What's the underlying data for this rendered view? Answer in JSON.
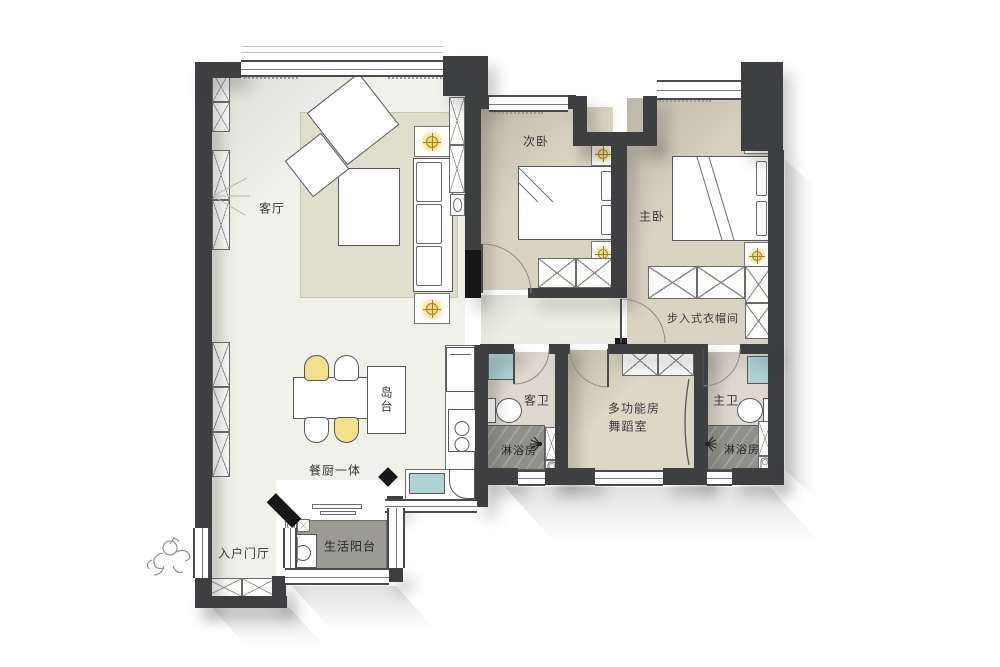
{
  "plan_type": "apartment-floor-plan",
  "rooms": {
    "living_room": "客厅",
    "secondary_bedroom": "次卧",
    "master_bedroom": "主卧",
    "walk_in_closet": "步入式衣帽间",
    "dining_kitchen": "餐厨一体",
    "kitchen_island": "岛台",
    "guest_bathroom": "客卫",
    "guest_shower_room": "淋浴房",
    "multifunction_room": "多功能房",
    "dance_studio": "舞蹈室",
    "master_bathroom": "主卫",
    "master_shower_room": "淋浴房",
    "entry_foyer": "入户门厅",
    "utility_balcony": "生活阳台"
  },
  "colors": {
    "wall": "#3e3f41",
    "floor_main": "#f0f1e8",
    "floor_bedroom": "#d9d3c2",
    "floor_multifunction": "#ddd8c6",
    "floor_bathroom": "#ded9ce",
    "shower_gray": "#8f908a",
    "balcony_gray": "#9b9b94",
    "rug": "#dfddcc",
    "fixture_teal": "#aed3d4",
    "lamp_yellow": "#f0d878",
    "chair_yellow": "#f2e188"
  }
}
